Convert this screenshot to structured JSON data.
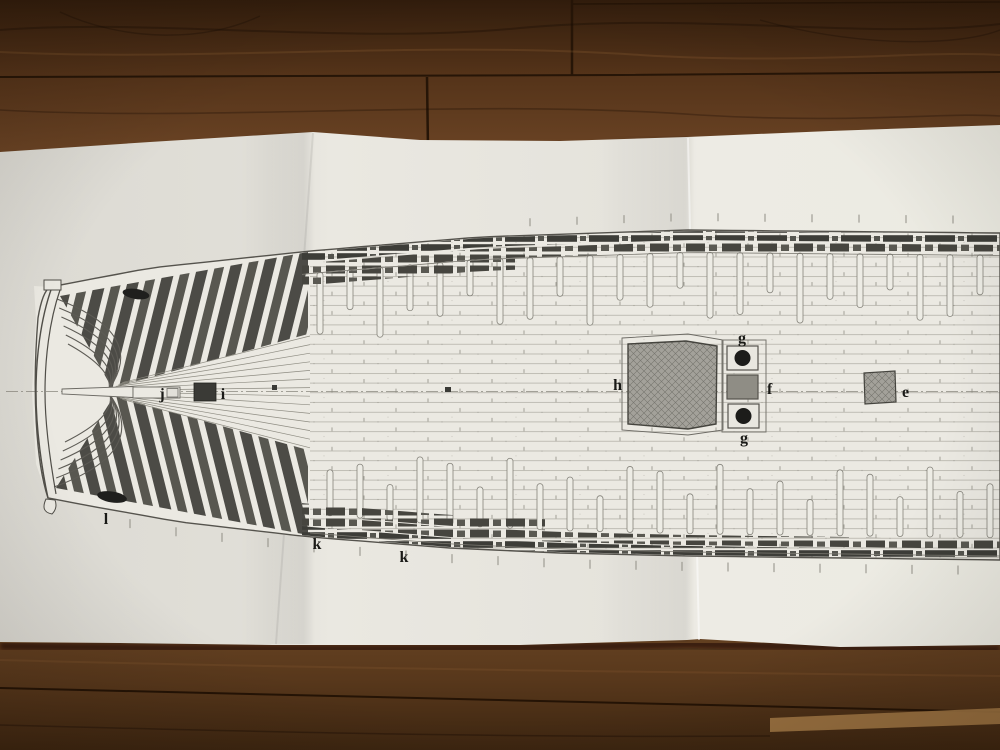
{
  "scene": {
    "paper_color": "#eae8e1",
    "ink_color": "#55534d",
    "wood_dark": "#36200e",
    "wood_mid": "#5a3a1d",
    "wood_light": "#a1743f",
    "hatch_fill": "#a3a19a",
    "small_hatch_fill": "#8f8d85",
    "pump_circle_color": "#1c1c1a"
  },
  "plan_labels": {
    "e": "e",
    "f": "f",
    "g_top": "g",
    "g_bottom": "g",
    "h": "h",
    "i": "i",
    "j": "j",
    "k_fore": "k",
    "k_aft": "k",
    "l": "l"
  }
}
